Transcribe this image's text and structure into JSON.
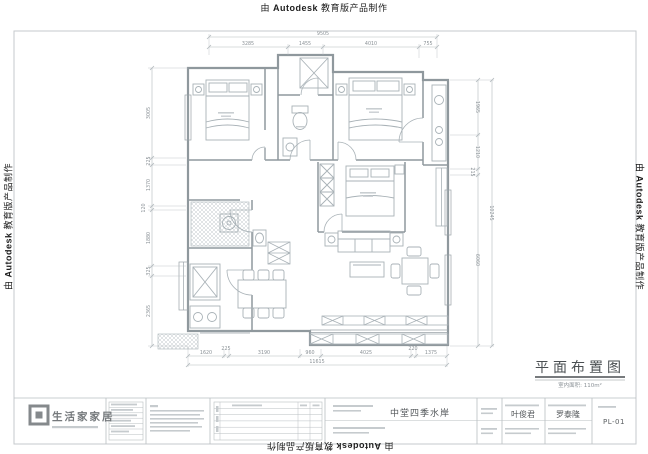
{
  "watermark": {
    "prefix": "由",
    "brand": "Autodesk",
    "suffix": "教育版产品制作"
  },
  "plan_title": {
    "title": "平面布置图",
    "subtitle": "室内面积: 110m²"
  },
  "dims": {
    "top": {
      "total": "9505",
      "segments": [
        "3285",
        "1455",
        "4010",
        "755"
      ]
    },
    "left": {
      "segments": [
        "3005",
        "225",
        "1370",
        "120",
        "1880",
        "325",
        "2365"
      ]
    },
    "right": {
      "total": "10245",
      "segments": [
        "1965",
        "1210",
        "215",
        "6060"
      ]
    },
    "bottom": {
      "total": "11615",
      "segments": [
        "1620",
        "225",
        "3190",
        "960",
        "4025",
        "220",
        "1375"
      ]
    }
  },
  "title_block": {
    "company": "生活家家居",
    "project": "中堂四季水岸",
    "designer": "叶俊君",
    "reviewer": "罗泰隆",
    "sheet_no": "PL-01"
  }
}
